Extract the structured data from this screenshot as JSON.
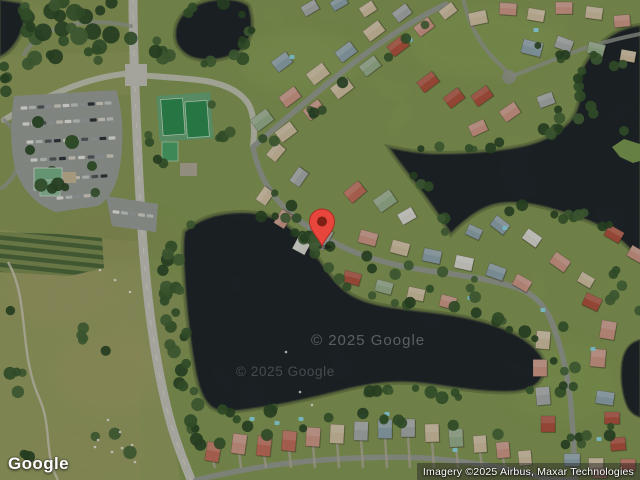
{
  "branding": {
    "logo_text": "Google"
  },
  "attribution": {
    "text": "Imagery ©2025 Airbus, Maxar Technologies"
  },
  "watermarks": {
    "first": "© 2025 Google",
    "second": "© 2025 Google"
  },
  "marker": {
    "description": "red-location-pin",
    "fill": "#E8453C",
    "core": "#7E1F15",
    "outline": "#A62E20"
  },
  "palette": {
    "water": "#20272A",
    "shore": "#4E5A40",
    "grass": "#8A9858",
    "grass_light": "#A2A46B",
    "grass_res": "#7C9B53",
    "road_major": "#C6C6BC",
    "road_minor": "#979C93",
    "asphalt": "#9BA09B",
    "tree": "#33512E",
    "tennis": "#2F8F52",
    "tennis_pad": "#6AA878",
    "pool": "#8FD8E2",
    "roofs": {
      "salmon": "#C4705C",
      "red": "#B2543F",
      "pink": "#D09B8A",
      "tan": "#D3C3A4",
      "gray": "#AAAFAD",
      "blue": "#92A8B0",
      "green": "#9BB290",
      "white": "#DCDCD4"
    }
  }
}
